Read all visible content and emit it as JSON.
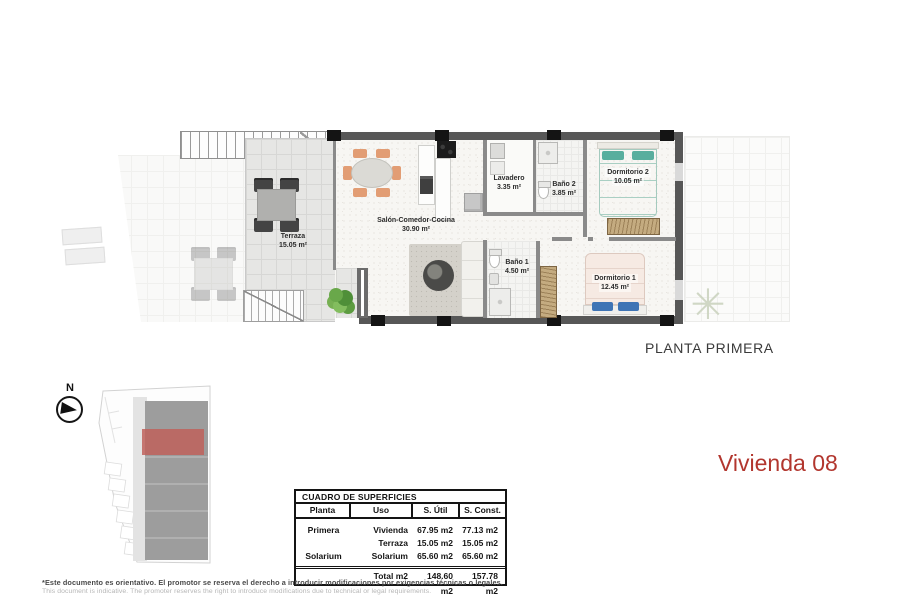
{
  "page": {
    "plan_title": "PLANTA PRIMERA",
    "unit_title": "Vivienda 08",
    "disclaimer_es": "*Este documento es orientativo. El promotor se reserva el derecho a introducir modificaciones por exigencias técnicas o legales.",
    "disclaimer_en": "This document is indicative. The promoter reserves the right to introduce modifications due to technical or legal requirements."
  },
  "compass": {
    "label": "N"
  },
  "floorplan": {
    "rooms": [
      {
        "name": "Terraza",
        "area": "15.05 m²"
      },
      {
        "name": "Salón-Comedor-Cocina",
        "area": "30.90 m²"
      },
      {
        "name": "Lavadero",
        "area": "3.35 m²"
      },
      {
        "name": "Baño 2",
        "area": "3.85 m²"
      },
      {
        "name": "Dormitorio 2",
        "area": "10.05 m²"
      },
      {
        "name": "Baño 1",
        "area": "4.50 m²"
      },
      {
        "name": "Dormitorio 1",
        "area": "12.45 m²"
      }
    ],
    "icons": {
      "palm": "✳"
    }
  },
  "table": {
    "title": "CUADRO DE SUPERFICIES",
    "headers": [
      "Planta",
      "Uso",
      "S. Útil",
      "S. Const."
    ],
    "rows": [
      [
        "Primera",
        "Vivienda",
        "67.95 m2",
        "77.13 m2"
      ],
      [
        "",
        "Terraza",
        "15.05 m2",
        "15.05 m2"
      ],
      [
        "Solarium",
        "Solarium",
        "65.60 m2",
        "65.60 m2"
      ]
    ],
    "total": [
      "",
      "Total m2",
      "148.60 m2",
      "157.78 m2"
    ]
  },
  "colors": {
    "accent_red": "#b2362e",
    "site_highlight": "#c0625c",
    "wall": "#575757",
    "interior_wall": "#8a8a8a",
    "bed_teal": "#58ae9e",
    "bed_blue": "#3f74b5",
    "wardrobe_brown": "#c4ab80",
    "chair_peach": "#e29d74",
    "plant_green": "#69a84a"
  }
}
